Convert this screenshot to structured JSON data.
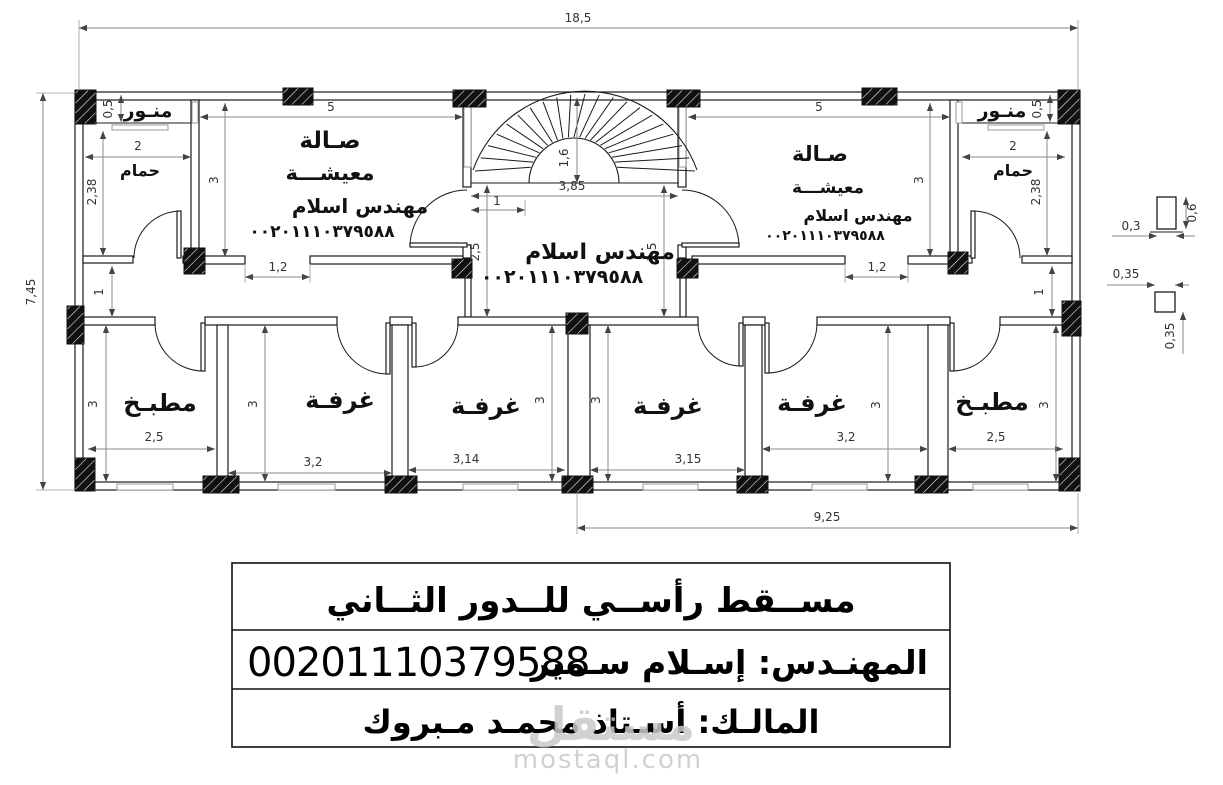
{
  "labels": {
    "light_well": "منـور",
    "bathroom": "حمام",
    "hall_line1": "صـالة",
    "hall_line2": "معيشـــة",
    "engineer_signature": "مهندس اسلام",
    "phone_arabic": "٠٠٢٠١١١٠٣٧٩٥٨٨",
    "kitchen": "مطبـخ",
    "room": "غرفـة"
  },
  "dims": {
    "total_width": "18,5",
    "total_height": "7,45",
    "right_span": "9,25",
    "hall_width": "5",
    "hall_depth": "3",
    "bath_width": "2",
    "bath_depth": "2,38",
    "lightwell_depth": "0,5",
    "corridor_width": "1",
    "hall_door": "1,2",
    "stair_hall_depth": "2,5",
    "stair_width": "3,85",
    "stair_step": "1",
    "stair_radius": "1,6",
    "kitchen_width": "2,5",
    "room_depth": "3",
    "room1_width": "3,2",
    "room2_width": "3,14",
    "room3_width": "3,15",
    "room4_width": "3,2",
    "detail_col_width": "0,3",
    "detail_col_height": "0,6",
    "detail_col2_size": "0,35"
  },
  "title_block": {
    "title": "مســقط رأســي للــدور الثــاني",
    "engineer": "المهنـدس: إسـلام سـمير",
    "phone": "00201110379588",
    "owner": "المالـك: أسـتاذ محمـد مـبروك"
  },
  "watermark": {
    "logo": "مستقل",
    "domain": "mostaql.com"
  },
  "colors": {
    "line": "#1a1a1a",
    "dim": "#8a8a8a",
    "watermark": "#c9c9c9"
  }
}
